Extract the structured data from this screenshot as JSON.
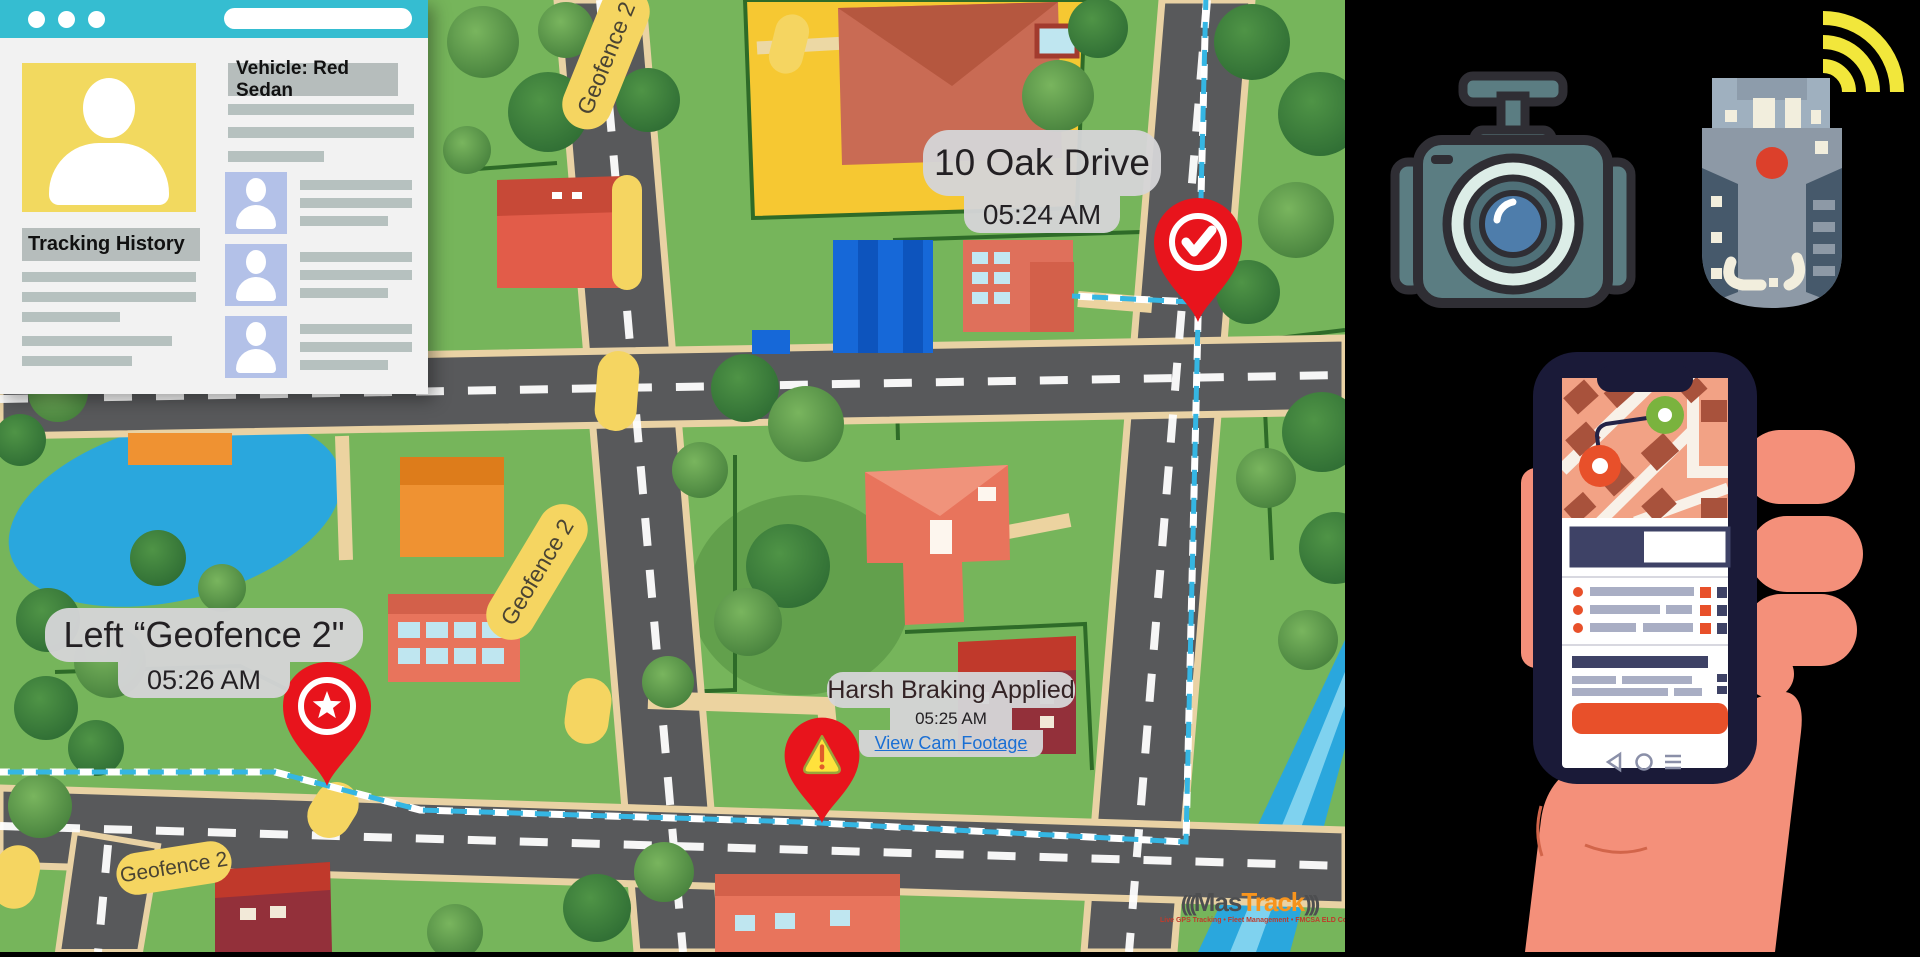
{
  "browser_window": {
    "address_bar_text": "",
    "vehicle_header": "Vehicle: Red Sedan",
    "profile_title": "Tracking History"
  },
  "map": {
    "tooltips": {
      "arrival": {
        "title": "10 Oak Drive",
        "time": "05:24 AM"
      },
      "harsh_braking": {
        "title": "Harsh Braking Applied",
        "time": "05:25 AM",
        "link_label": "View Cam Footage"
      },
      "geofence_exit": {
        "title": "Left “Geofence 2\"",
        "time": "05:26 AM"
      }
    },
    "geofence_labels": {
      "top": "Geofence 2",
      "middle": "Geofence 2",
      "bottom": "Geofence 2"
    }
  },
  "logo": {
    "signal_left": "(((",
    "name_part1": "Mas",
    "name_part2": "Track",
    "signal_right": ")))",
    "tagline": "Live GPS Tracking • Fleet Management • FMCSA ELD Compliance"
  },
  "colors": {
    "route_cyan": "#35b6e3",
    "pin_red": "#e8141c",
    "geofence_yellow": "#f5d561",
    "brand_orange": "#f7941d",
    "titlebar_teal": "#35bdd1",
    "cta_orange": "#e8502a"
  }
}
